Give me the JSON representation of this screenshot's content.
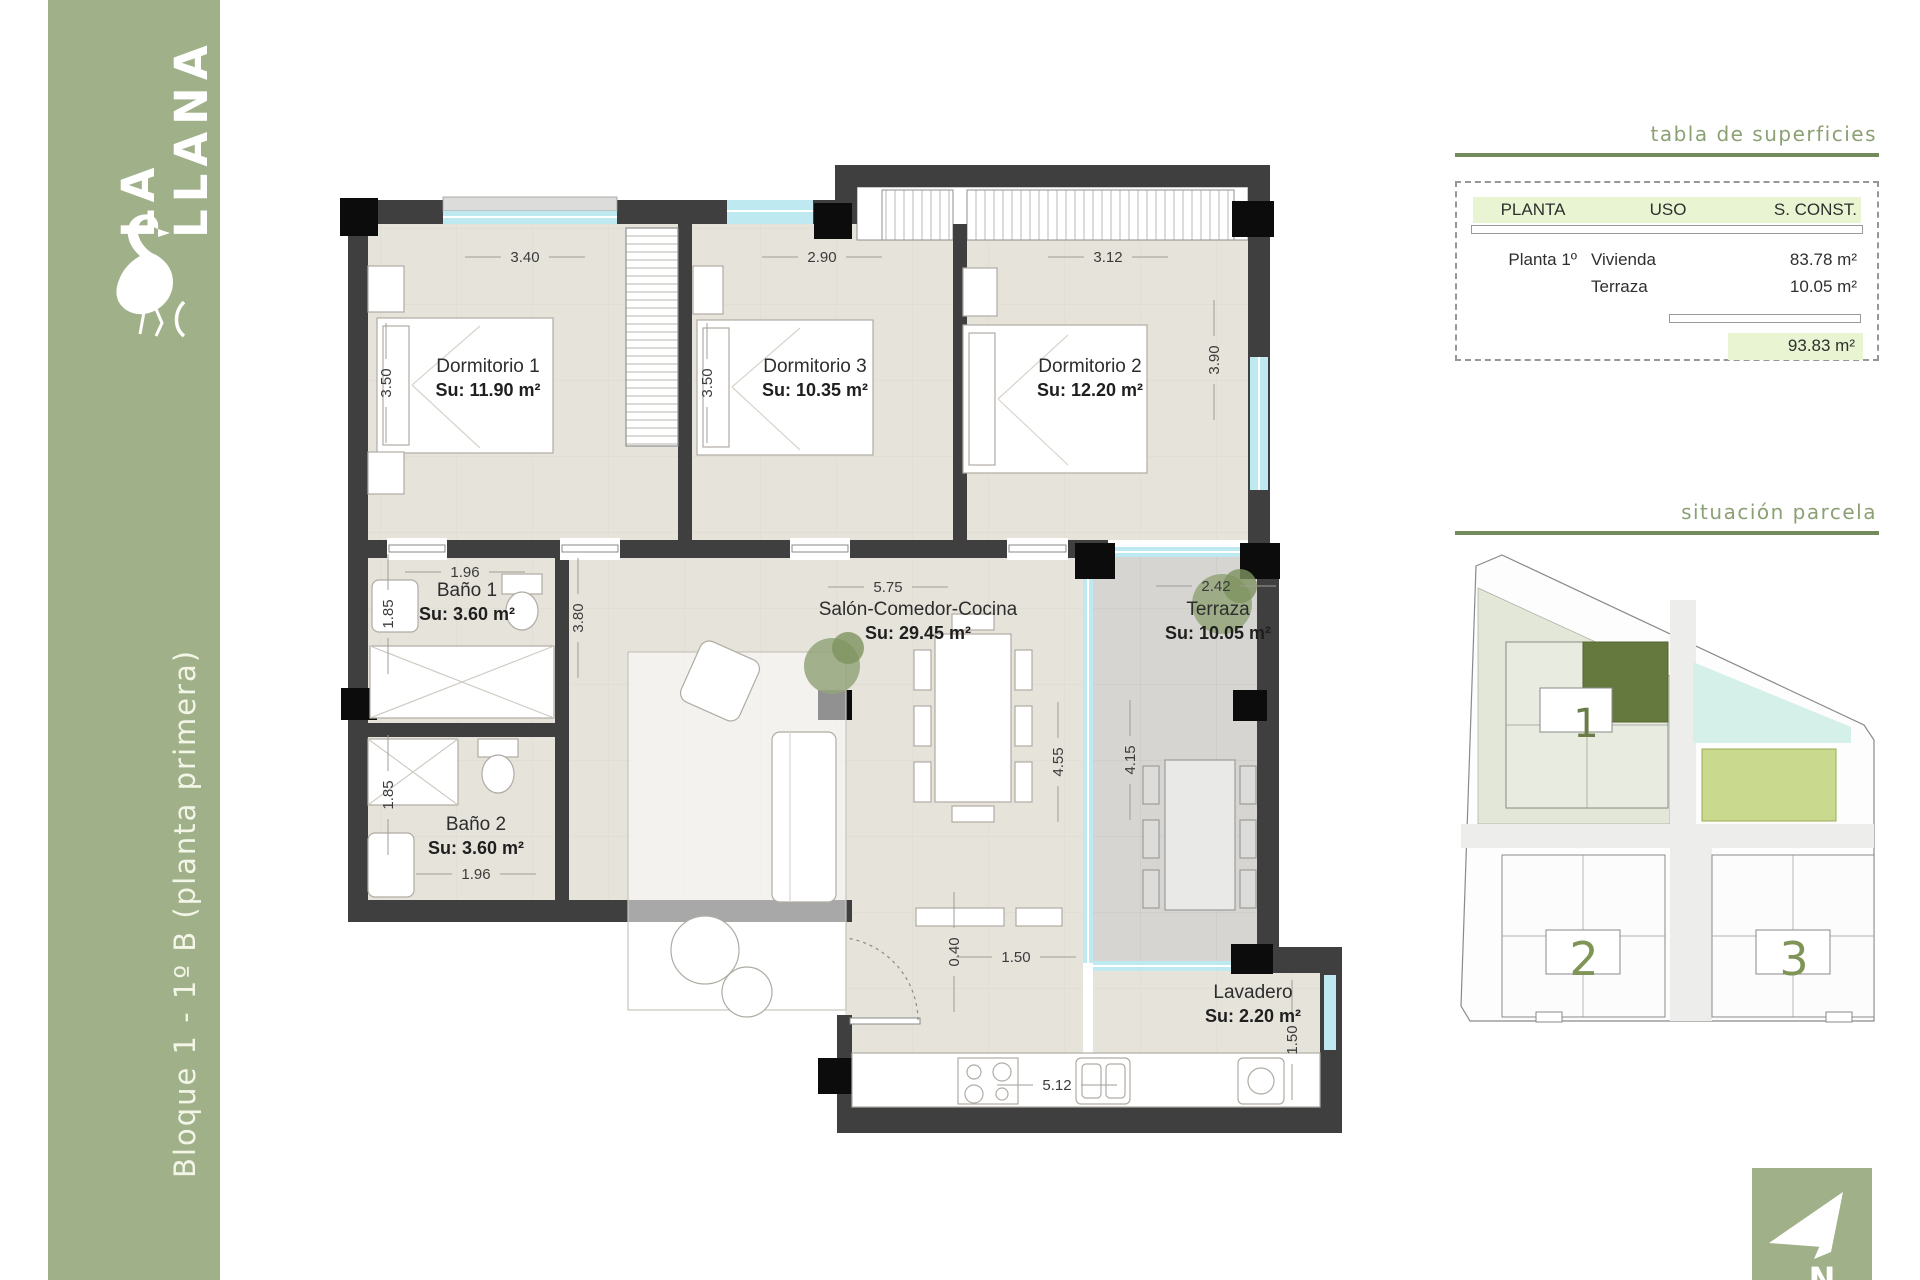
{
  "sidebar": {
    "logo_line1": "LA",
    "logo_line2": "LLANA",
    "logo_line3": "towers",
    "title": "Bloque 1 - 1º B (planta primera)"
  },
  "surfaces_panel": {
    "title": "tabla de superficies",
    "headers": [
      "PLANTA",
      "USO",
      "S. CONST."
    ],
    "rows": [
      {
        "planta": "Planta 1º",
        "uso": "Vivienda",
        "sconst": "83.78 m²"
      },
      {
        "planta": "",
        "uso": "Terraza",
        "sconst": "10.05 m²"
      }
    ],
    "total": "93.83 m²"
  },
  "site_panel": {
    "title": "situación parcela",
    "buildings": [
      "1",
      "2",
      "3"
    ]
  },
  "compass": {
    "north_label": "N"
  },
  "plan": {
    "rooms": [
      {
        "name": "Dormitorio 1",
        "area": "Su: 11.90 m²",
        "x": 488,
        "y": 372
      },
      {
        "name": "Dormitorio 3",
        "area": "Su: 10.35 m²",
        "x": 815,
        "y": 372
      },
      {
        "name": "Dormitorio 2",
        "area": "Su: 12.20 m²",
        "x": 1090,
        "y": 372
      },
      {
        "name": "Baño 1",
        "area": "Su: 3.60 m²",
        "x": 467,
        "y": 596
      },
      {
        "name": "Baño 2",
        "area": "Su: 3.60 m²",
        "x": 476,
        "y": 830
      },
      {
        "name": "Salón-Comedor-Cocina",
        "area": "Su: 29.45 m²",
        "x": 918,
        "y": 615
      },
      {
        "name": "Terraza",
        "area": "Su: 10.05 m²",
        "x": 1218,
        "y": 615
      },
      {
        "name": "Lavadero",
        "area": "Su: 2.20 m²",
        "x": 1253,
        "y": 998
      }
    ],
    "dimensions": [
      {
        "t": "3.40",
        "x": 525,
        "y": 262,
        "r": 0
      },
      {
        "t": "2.90",
        "x": 822,
        "y": 262,
        "r": 0
      },
      {
        "t": "3.12",
        "x": 1108,
        "y": 262,
        "r": 0
      },
      {
        "t": "3.50",
        "x": 391,
        "y": 383,
        "r": -90
      },
      {
        "t": "3.50",
        "x": 712,
        "y": 383,
        "r": -90
      },
      {
        "t": "3.90",
        "x": 1219,
        "y": 360,
        "r": -90
      },
      {
        "t": "1.96",
        "x": 465,
        "y": 577,
        "r": 0
      },
      {
        "t": "1.85",
        "x": 393,
        "y": 614,
        "r": -90
      },
      {
        "t": "1.85",
        "x": 393,
        "y": 795,
        "r": -90
      },
      {
        "t": "1.96",
        "x": 476,
        "y": 879,
        "r": 0
      },
      {
        "t": "5.75",
        "x": 888,
        "y": 592,
        "r": 0
      },
      {
        "t": "3.80",
        "x": 583,
        "y": 618,
        "r": -90
      },
      {
        "t": "4.55",
        "x": 1063,
        "y": 762,
        "r": -90
      },
      {
        "t": "4.15",
        "x": 1135,
        "y": 760,
        "r": -90
      },
      {
        "t": "2.42",
        "x": 1216,
        "y": 591,
        "r": 0
      },
      {
        "t": "0.40",
        "x": 959,
        "y": 952,
        "r": -90
      },
      {
        "t": "1.50",
        "x": 1016,
        "y": 962,
        "r": 0
      },
      {
        "t": "5.12",
        "x": 1057,
        "y": 1090,
        "r": 0
      },
      {
        "t": "1.50",
        "x": 1297,
        "y": 1040,
        "r": -90
      }
    ]
  },
  "colors": {
    "sidebar_green": "#a0b189",
    "accent_green_dark": "#74895c",
    "accent_green_text": "#8ba173",
    "row_highlight": "#e9f5d2",
    "unit_highlight": "#65793f",
    "teal_area": "#d5f0e9",
    "pool_green": "#c9da8f",
    "number_green": "#7f9456",
    "wall": "#3f3f3f",
    "glass": "#bfe9f1",
    "floor": "#e6e3db",
    "terrace_floor": "#d6d5d1"
  }
}
